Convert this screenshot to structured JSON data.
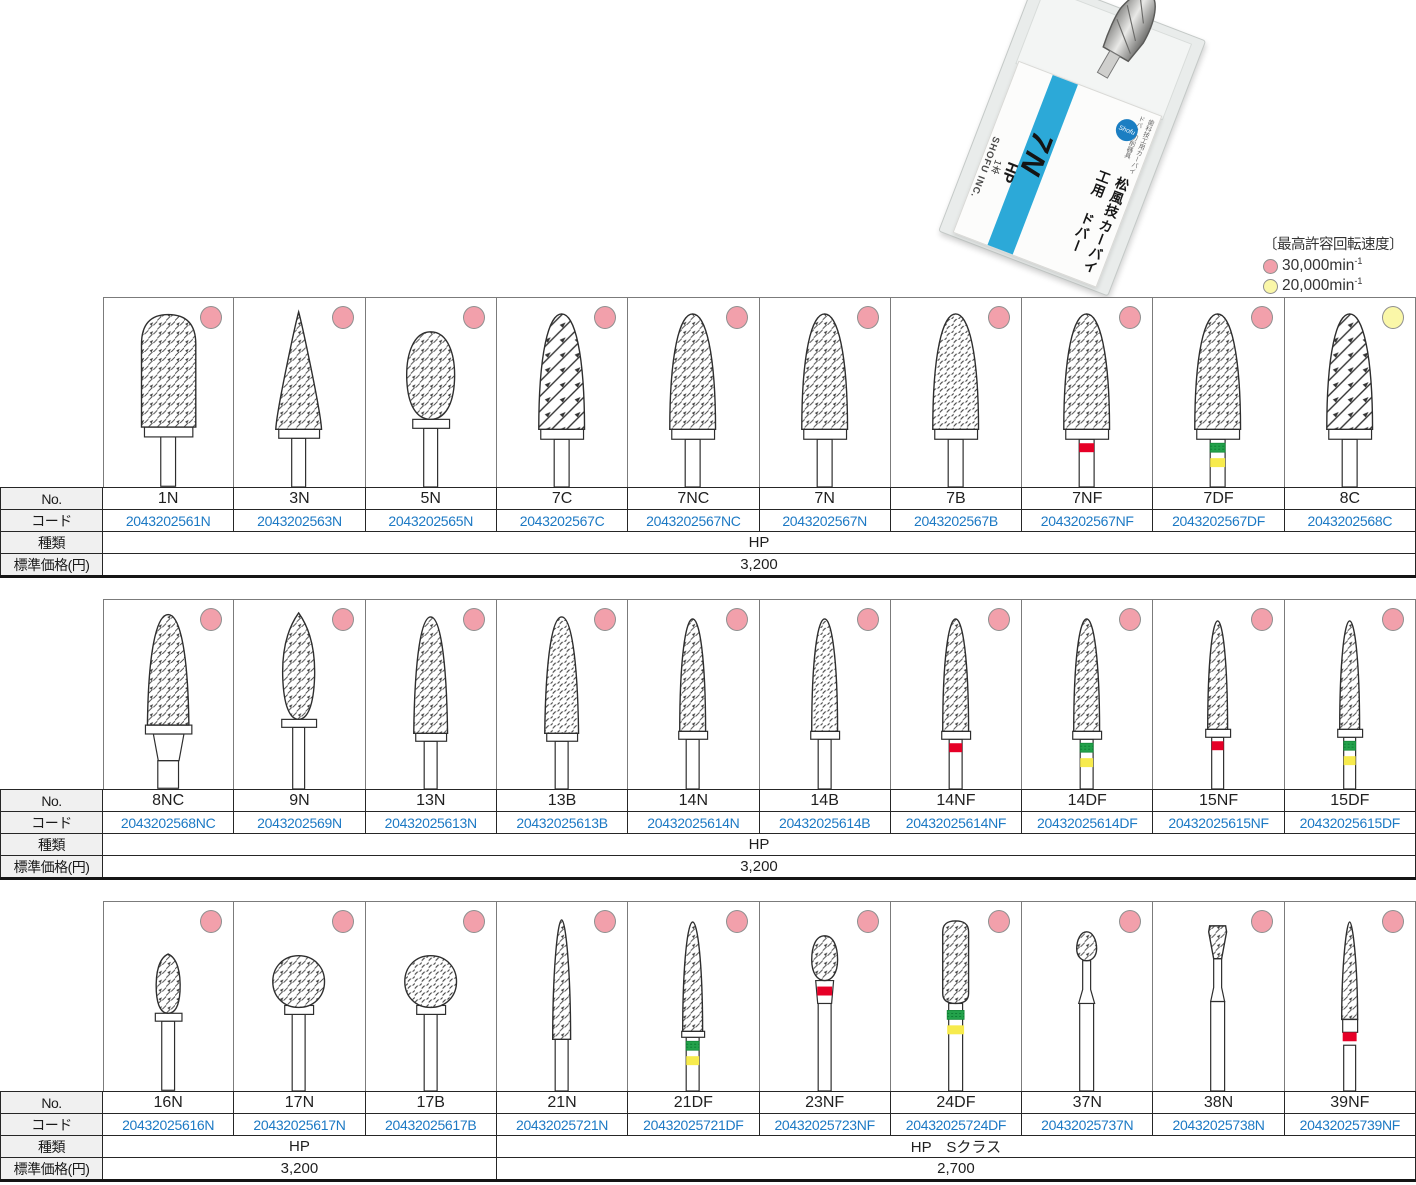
{
  "product_box": {
    "small_label": "歯科技工用カーバイドバー切削器具",
    "title_line1": "松風技工用",
    "title_line2": "カーバイドバー",
    "model": "7N",
    "type": "HP",
    "count": "1本",
    "brand": "SHOFU INC.",
    "logo": "Shofu"
  },
  "legend": {
    "title": "〔最高許容回転速度〕",
    "items": [
      {
        "color_name": "pink",
        "label": "30,000min",
        "sup": "-1"
      },
      {
        "color_name": "yellow",
        "label": "20,000min",
        "sup": "-1"
      }
    ]
  },
  "row_labels": {
    "no": "No.",
    "code": "コード",
    "type": "種類",
    "price": "標準価格(円)"
  },
  "colors": {
    "dot_pink": "#F2A0AB",
    "dot_yellow": "#FAF7A8",
    "dot_border": "#8F8F8F",
    "code_blue": "#1C79C4",
    "band_red": "#E60027",
    "band_green": "#23A24B",
    "band_yellow": "#F7EB4D",
    "stripe_blue": "#2CA9D8",
    "logo_blue": "#1B7EC2"
  },
  "tables": [
    {
      "id": "table-1",
      "burs": [
        {
          "no": "1N",
          "code": "2043202561N",
          "shape": "dome-cylinder",
          "dot": "pink",
          "bands": []
        },
        {
          "no": "3N",
          "code": "2043202563N",
          "shape": "cone",
          "dot": "pink",
          "bands": []
        },
        {
          "no": "5N",
          "code": "2043202565N",
          "shape": "egg",
          "dot": "pink",
          "bands": []
        },
        {
          "no": "7C",
          "code": "2043202567C",
          "shape": "flame-coarse",
          "dot": "pink",
          "bands": []
        },
        {
          "no": "7NC",
          "code": "2043202567NC",
          "shape": "flame",
          "dot": "pink",
          "bands": []
        },
        {
          "no": "7N",
          "code": "2043202567N",
          "shape": "flame",
          "dot": "pink",
          "bands": []
        },
        {
          "no": "7B",
          "code": "2043202567B",
          "shape": "flame-lines",
          "dot": "pink",
          "bands": []
        },
        {
          "no": "7NF",
          "code": "2043202567NF",
          "shape": "flame",
          "dot": "pink",
          "bands": [
            "red"
          ]
        },
        {
          "no": "7DF",
          "code": "2043202567DF",
          "shape": "flame",
          "dot": "pink",
          "bands": [
            "green",
            "yellow"
          ]
        },
        {
          "no": "8C",
          "code": "2043202568C",
          "shape": "flame-coarse",
          "dot": "yellow",
          "bands": []
        }
      ],
      "type_groups": [
        {
          "label": "HP",
          "span": 10
        }
      ],
      "price_groups": [
        {
          "label": "3,200",
          "span": 10
        }
      ]
    },
    {
      "id": "table-2",
      "burs": [
        {
          "no": "8NC",
          "code": "2043202568NC",
          "shape": "taper-8nc",
          "dot": "pink",
          "bands": []
        },
        {
          "no": "9N",
          "code": "2043202569N",
          "shape": "bud",
          "dot": "pink",
          "bands": []
        },
        {
          "no": "13N",
          "code": "20432025613N",
          "shape": "taper-med",
          "dot": "pink",
          "bands": []
        },
        {
          "no": "13B",
          "code": "20432025613B",
          "shape": "taper-med-lines",
          "dot": "pink",
          "bands": []
        },
        {
          "no": "14N",
          "code": "20432025614N",
          "shape": "taper-slim",
          "dot": "pink",
          "bands": []
        },
        {
          "no": "14B",
          "code": "20432025614B",
          "shape": "taper-slim-lines",
          "dot": "pink",
          "bands": []
        },
        {
          "no": "14NF",
          "code": "20432025614NF",
          "shape": "taper-slim",
          "dot": "pink",
          "bands": [
            "red"
          ]
        },
        {
          "no": "14DF",
          "code": "20432025614DF",
          "shape": "taper-slim",
          "dot": "pink",
          "bands": [
            "green",
            "yellow"
          ]
        },
        {
          "no": "15NF",
          "code": "20432025615NF",
          "shape": "taper-xslim",
          "dot": "pink",
          "bands": [
            "red"
          ]
        },
        {
          "no": "15DF",
          "code": "20432025615DF",
          "shape": "taper-xslim",
          "dot": "pink",
          "bands": [
            "green",
            "yellow"
          ]
        }
      ],
      "type_groups": [
        {
          "label": "HP",
          "span": 10
        }
      ],
      "price_groups": [
        {
          "label": "3,200",
          "span": 10
        }
      ]
    },
    {
      "id": "table-3",
      "burs": [
        {
          "no": "16N",
          "code": "20432025616N",
          "shape": "small-bud",
          "dot": "pink",
          "bands": []
        },
        {
          "no": "17N",
          "code": "20432025617N",
          "shape": "ball",
          "dot": "pink",
          "bands": []
        },
        {
          "no": "17B",
          "code": "20432025617B",
          "shape": "ball-lines",
          "dot": "pink",
          "bands": []
        },
        {
          "no": "21N",
          "code": "20432025721N",
          "shape": "needle",
          "dot": "pink",
          "bands": []
        },
        {
          "no": "21DF",
          "code": "20432025721DF",
          "shape": "taper-21df",
          "dot": "pink",
          "bands": [
            "green",
            "yellow"
          ]
        },
        {
          "no": "23NF",
          "code": "20432025723NF",
          "shape": "small-egg-neck",
          "dot": "pink",
          "bands": [
            "red"
          ]
        },
        {
          "no": "24DF",
          "code": "20432025724DF",
          "shape": "small-roundcyl",
          "dot": "pink",
          "bands": [
            "green",
            "yellow"
          ]
        },
        {
          "no": "37N",
          "code": "20432025737N",
          "shape": "tiny-pear",
          "dot": "pink",
          "bands": []
        },
        {
          "no": "38N",
          "code": "20432025738N",
          "shape": "tiny-invcone",
          "dot": "pink",
          "bands": []
        },
        {
          "no": "39NF",
          "code": "20432025739NF",
          "shape": "needle-band",
          "dot": "pink",
          "bands": [
            "red"
          ]
        }
      ],
      "type_groups": [
        {
          "label": "HP",
          "span": 3
        },
        {
          "label": "HP　Sクラス",
          "span": 7
        }
      ],
      "price_groups": [
        {
          "label": "3,200",
          "span": 3
        },
        {
          "label": "2,700",
          "span": 7
        }
      ]
    }
  ]
}
